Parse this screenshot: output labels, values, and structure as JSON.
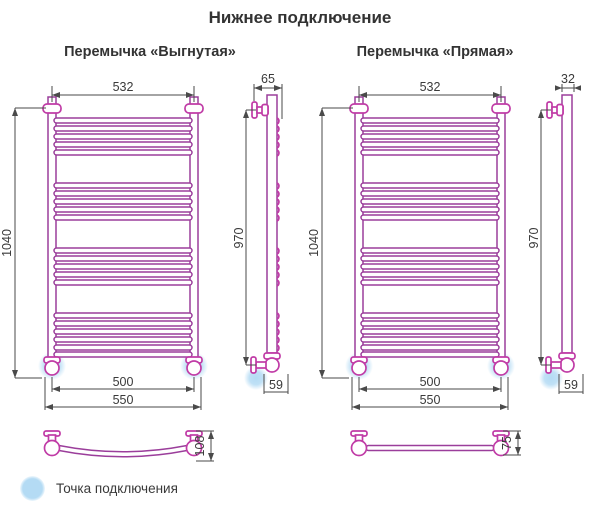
{
  "title": "Нижнее подключение",
  "columns": {
    "left": {
      "subtitle": "Перемычка «Выгнутая»",
      "front": {
        "overall_width": "532",
        "overall_height": "1040",
        "connection_spacing": "500",
        "outer_width": "550"
      },
      "side": {
        "depth": "65",
        "mount_height": "970",
        "bottom_offset": "59"
      },
      "crossbar": {
        "bow_depth": "108"
      }
    },
    "right": {
      "subtitle": "Перемычка «Прямая»",
      "front": {
        "overall_width": "532",
        "overall_height": "1040",
        "connection_spacing": "500",
        "outer_width": "550"
      },
      "side": {
        "depth": "32",
        "mount_height": "970",
        "bottom_offset": "59"
      },
      "crossbar": {
        "bow_depth": "75"
      }
    }
  },
  "legend": {
    "label": "Точка подключения"
  },
  "colors": {
    "tube": "#9b3e9b",
    "fitting": "#c03ba6",
    "dimension": "#4a4a4a",
    "connection_point": "#b4dbf4",
    "text": "#333333"
  }
}
